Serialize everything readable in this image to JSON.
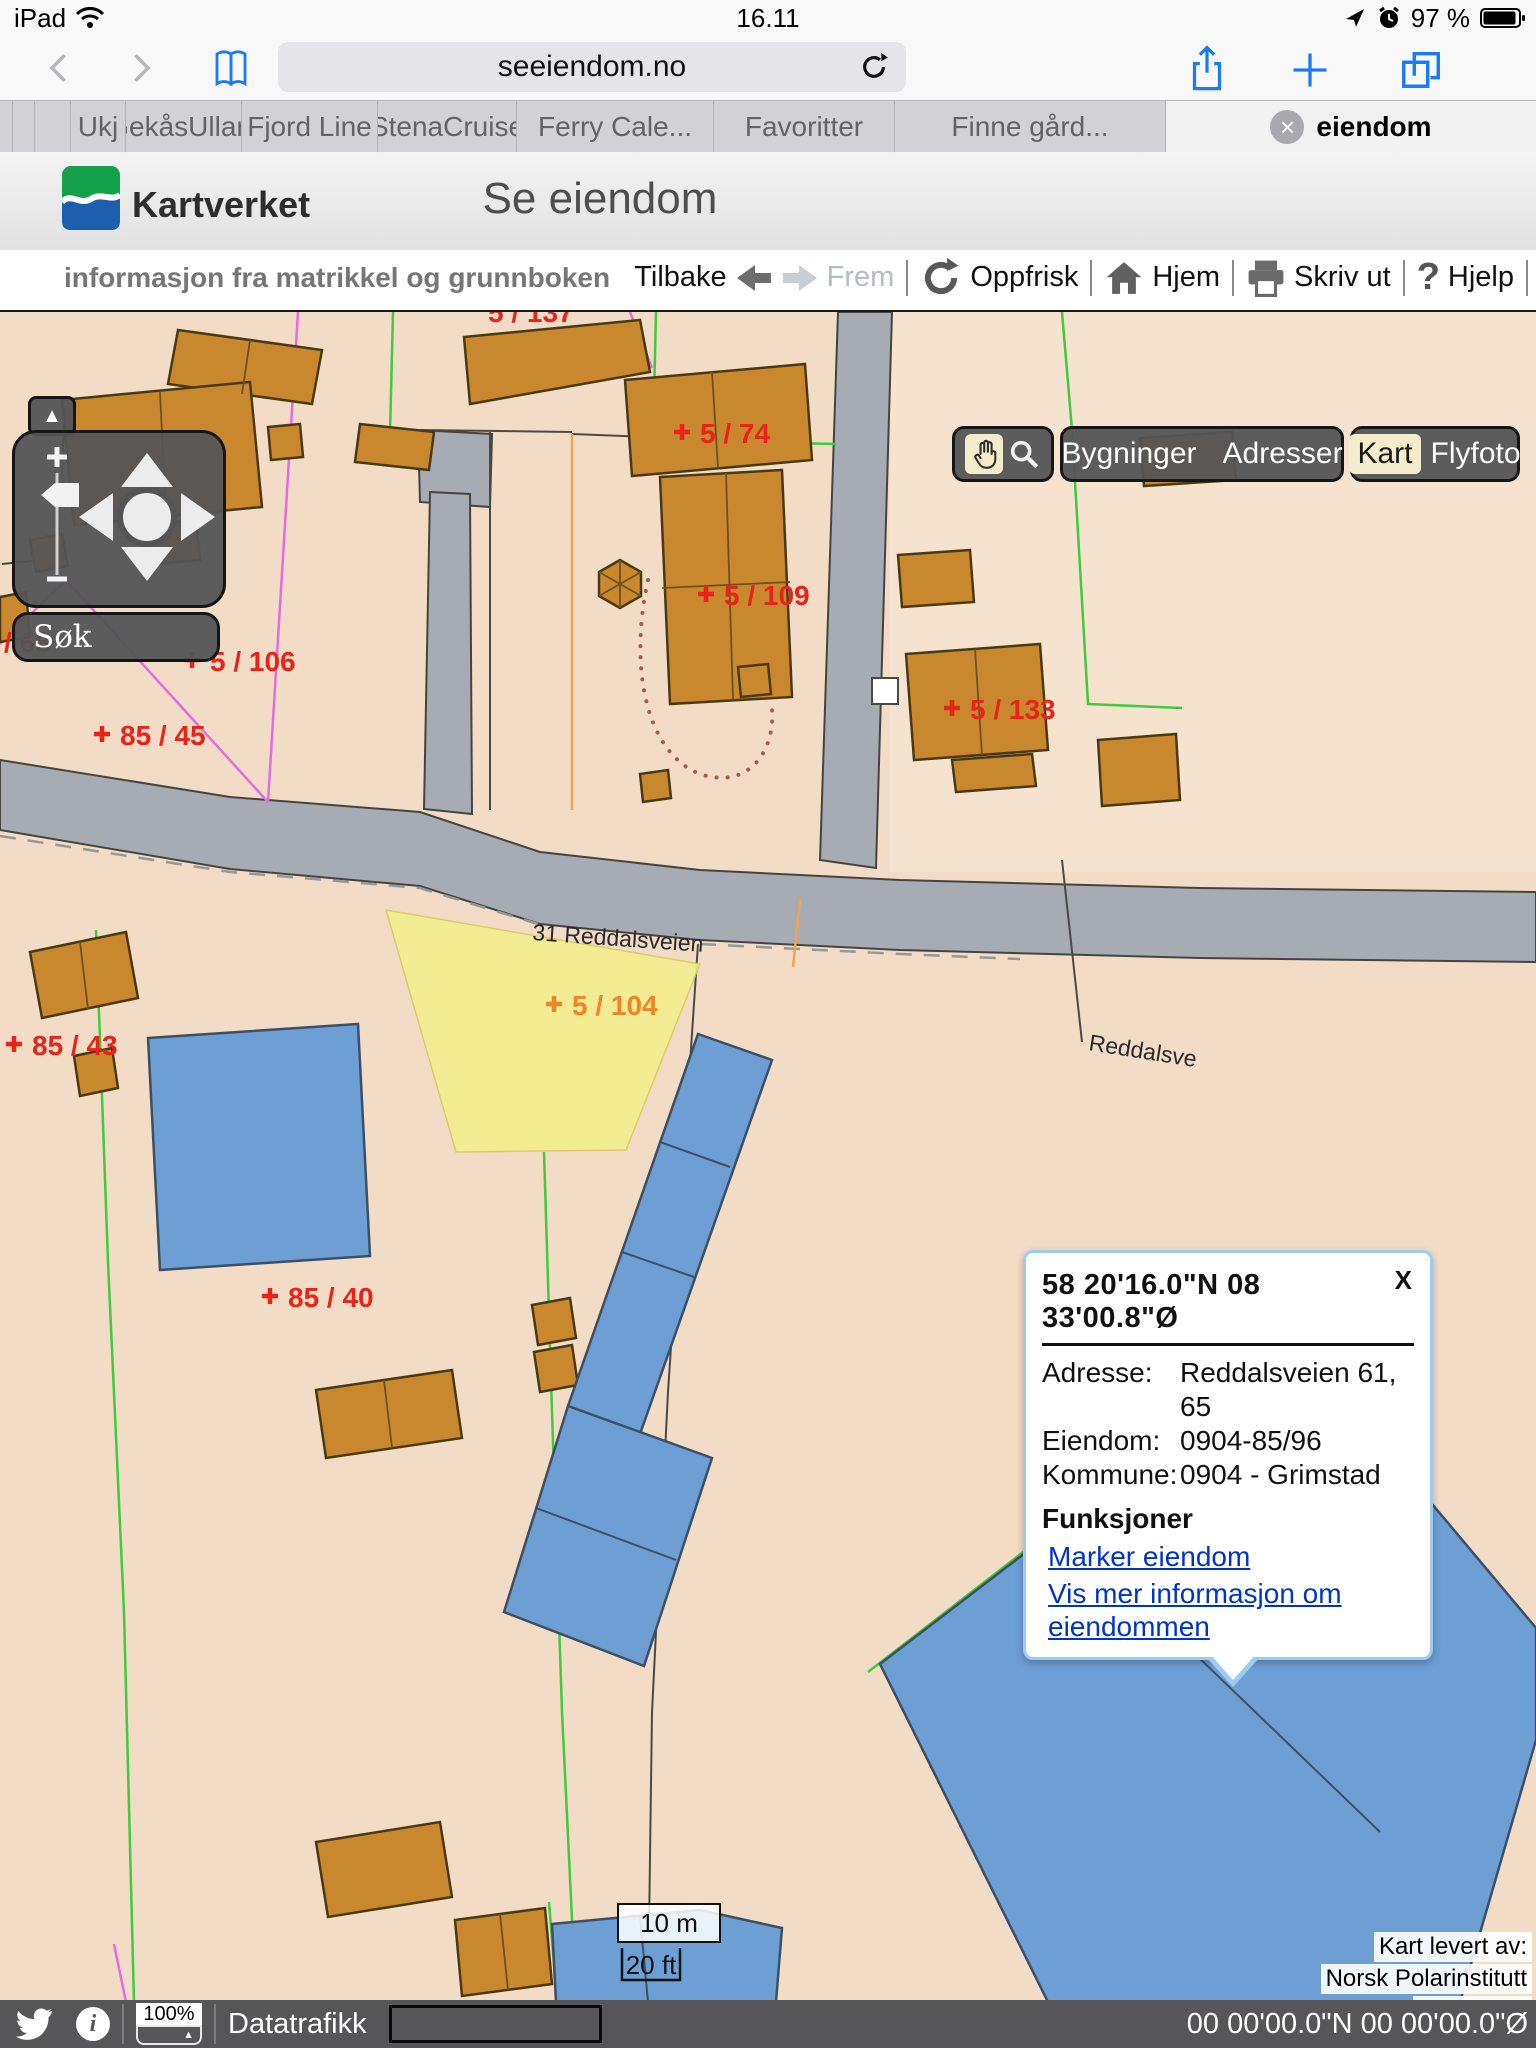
{
  "status_bar": {
    "carrier": "iPad",
    "time": "16.11",
    "battery_pct": "97 %"
  },
  "safari": {
    "url": "seeiendom.no",
    "tabs": [
      {
        "label": "Ukj"
      },
      {
        "label": "GekåsUllar.."
      },
      {
        "label": "Fjord Line"
      },
      {
        "label": "StenaCruise"
      },
      {
        "label": "Ferry Cale..."
      },
      {
        "label": "Favoritter"
      },
      {
        "label": "Finne gård..."
      },
      {
        "label": "eiendom"
      }
    ]
  },
  "header": {
    "logo": "Kartverket",
    "title": "Se eiendom",
    "tagline": "informasjon fra matrikkel og grunnboken"
  },
  "toolbar": {
    "back": "Tilbake",
    "forward": "Frem",
    "refresh": "Oppfrisk",
    "home": "Hjem",
    "print": "Skriv ut",
    "help": "Hjelp",
    "help_mark": "?"
  },
  "controls": {
    "search": "Søk",
    "buildings": "Bygninger",
    "addresses": "Adresser",
    "map_mode": "Kart",
    "aerial_mode": "Flyfoto"
  },
  "icons": {
    "collapse": "▲",
    "dropdown": "▲",
    "close_tab": "×"
  },
  "map": {
    "street": "31 Reddalsveien",
    "street_right": "Reddalsve",
    "partial_label": "5 / 137",
    "parcels": [
      {
        "text": "5 / 74"
      },
      {
        "text": "5 / 109"
      },
      {
        "text": "5 / 106"
      },
      {
        "text": "85 / 45"
      },
      {
        "text": "/ 68"
      },
      {
        "text": "5 / 133"
      },
      {
        "text": "85 / 43"
      },
      {
        "text": "85 / 40"
      },
      {
        "text": "5 / 68"
      }
    ],
    "highlight_label": "5 / 104",
    "scale_m": "10 m",
    "scale_ft": "20 ft",
    "attribution": [
      "Kart levert av:",
      "Norsk Polarinstitutt",
      "Kartverket"
    ]
  },
  "popup": {
    "title": "58 20'16.0\"N 08 33'00.8\"Ø",
    "close": "X",
    "rows": [
      {
        "label": "Adresse:",
        "value": "Reddalsveien 61, 65"
      },
      {
        "label": "Eiendom:",
        "value": "0904-85/96"
      },
      {
        "label": "Kommune:",
        "value": "0904 - Grimstad"
      }
    ],
    "heading": "Funksjoner",
    "links": [
      {
        "text": "Marker eiendom"
      },
      {
        "text": "Vis mer informasjon om eiendommen"
      }
    ]
  },
  "bottom": {
    "zoom": "100%",
    "traffic": "Datatrafikk",
    "coords": "00 00'00.0\"N 00 00'00.0\"Ø"
  },
  "colors": {
    "accent_blue": "#1b7bf5",
    "kartverket_green": "#14a04a",
    "kartverket_blue": "#1b5fae",
    "parcel_red": "#e8231a",
    "highlight_orange": "#f08428",
    "link_blue": "#0033cc",
    "building_orange": "#c9882d",
    "building_blue": "#6d9fd4",
    "road_gray": "#a6abb4",
    "selection_yellow": "#f4ee8d"
  }
}
